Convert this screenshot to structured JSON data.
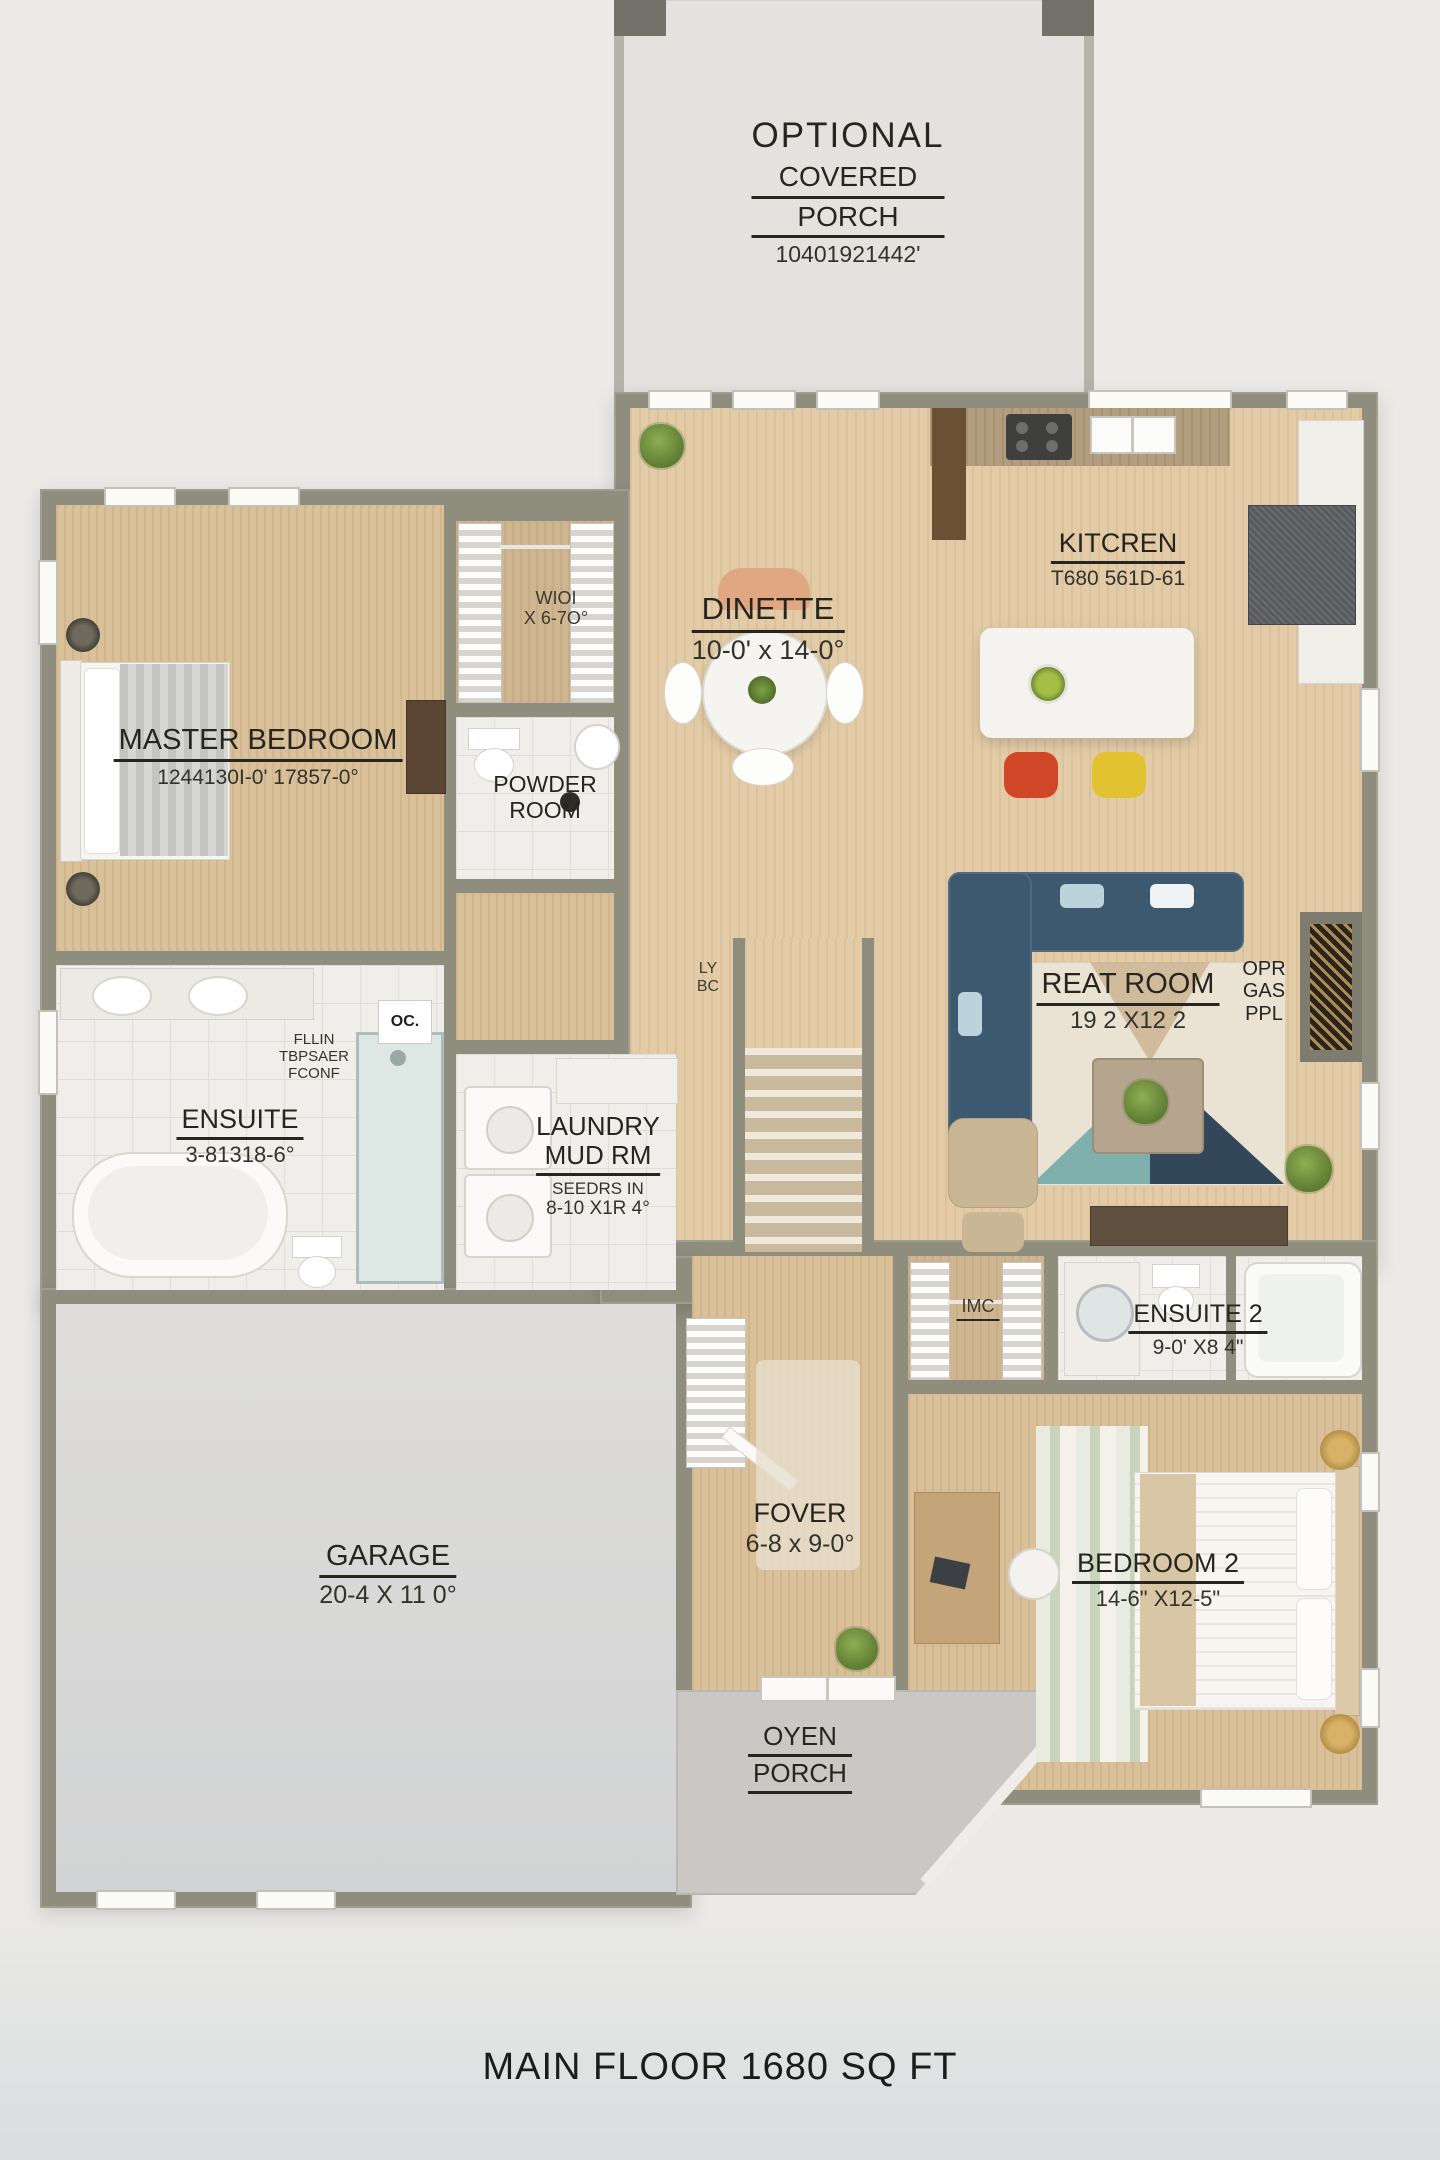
{
  "title": "MAIN FLOOR 1680 SQ FT",
  "rooms": {
    "optional_porch": {
      "line1": "OPTIONAL",
      "line2": "COVERED",
      "line3": "PORCH",
      "dims": "10401921442'"
    },
    "kitchen": {
      "name": "KITCREN",
      "dims": "T680 561D-61"
    },
    "dinette": {
      "name": "DINETTE",
      "dims": "10-0' x 14-0°"
    },
    "master": {
      "name": "MASTER BEDROOM",
      "dims": "1244130I-0' 17857-0°"
    },
    "wic": {
      "line1": "WIOI",
      "line2": "X 6-7O°"
    },
    "powder": {
      "line1": "POWDER",
      "line2": "ROOM"
    },
    "ensuite": {
      "name": "ENSUITE",
      "dims": "3-81318-6°",
      "note1": "FLLIN",
      "note2": "TBPSAER",
      "note3": "FCONF"
    },
    "laundry": {
      "line1": "LAUNDRY",
      "line2": "MUD RM",
      "note": "SEEDRS IN",
      "dims": "8-10 X1R 4°"
    },
    "great": {
      "name": "REAT ROOM",
      "dims": "19 2 X12 2"
    },
    "fireplace": {
      "line1": "OPR",
      "line2": "GAS",
      "line3": "PPL"
    },
    "ensuite2": {
      "name": "ENSUITE 2",
      "dims": "9-0' X8 4\""
    },
    "closet2": {
      "name": "IMC"
    },
    "garage": {
      "name": "GARAGE",
      "dims": "20-4 X 11 0°"
    },
    "foyer": {
      "name": "FOVER",
      "dims": "6-8 x 9-0°"
    },
    "bedroom2": {
      "name": "BEDROOM 2",
      "dims": "14-6\" X12-5\""
    },
    "porch": {
      "line1": "OYEN",
      "line2": "PORCH"
    },
    "stairs_note": {
      "line1": "LY",
      "line2": "BC"
    },
    "shower_tag": "OC."
  },
  "palette": {
    "wall": "#8f8d7e",
    "wood_floor": "#dac099",
    "tile_floor": "#f0eeea",
    "garage_floor": "#d8d8d6",
    "porch_floor": "#c9c8c4",
    "sofa_navy": "#3c5970",
    "stool_red": "#cf4727",
    "stool_yellow": "#e3c232",
    "plant_green": "#6e8f3e",
    "background": "#ebeae7",
    "text": "#26251f"
  }
}
